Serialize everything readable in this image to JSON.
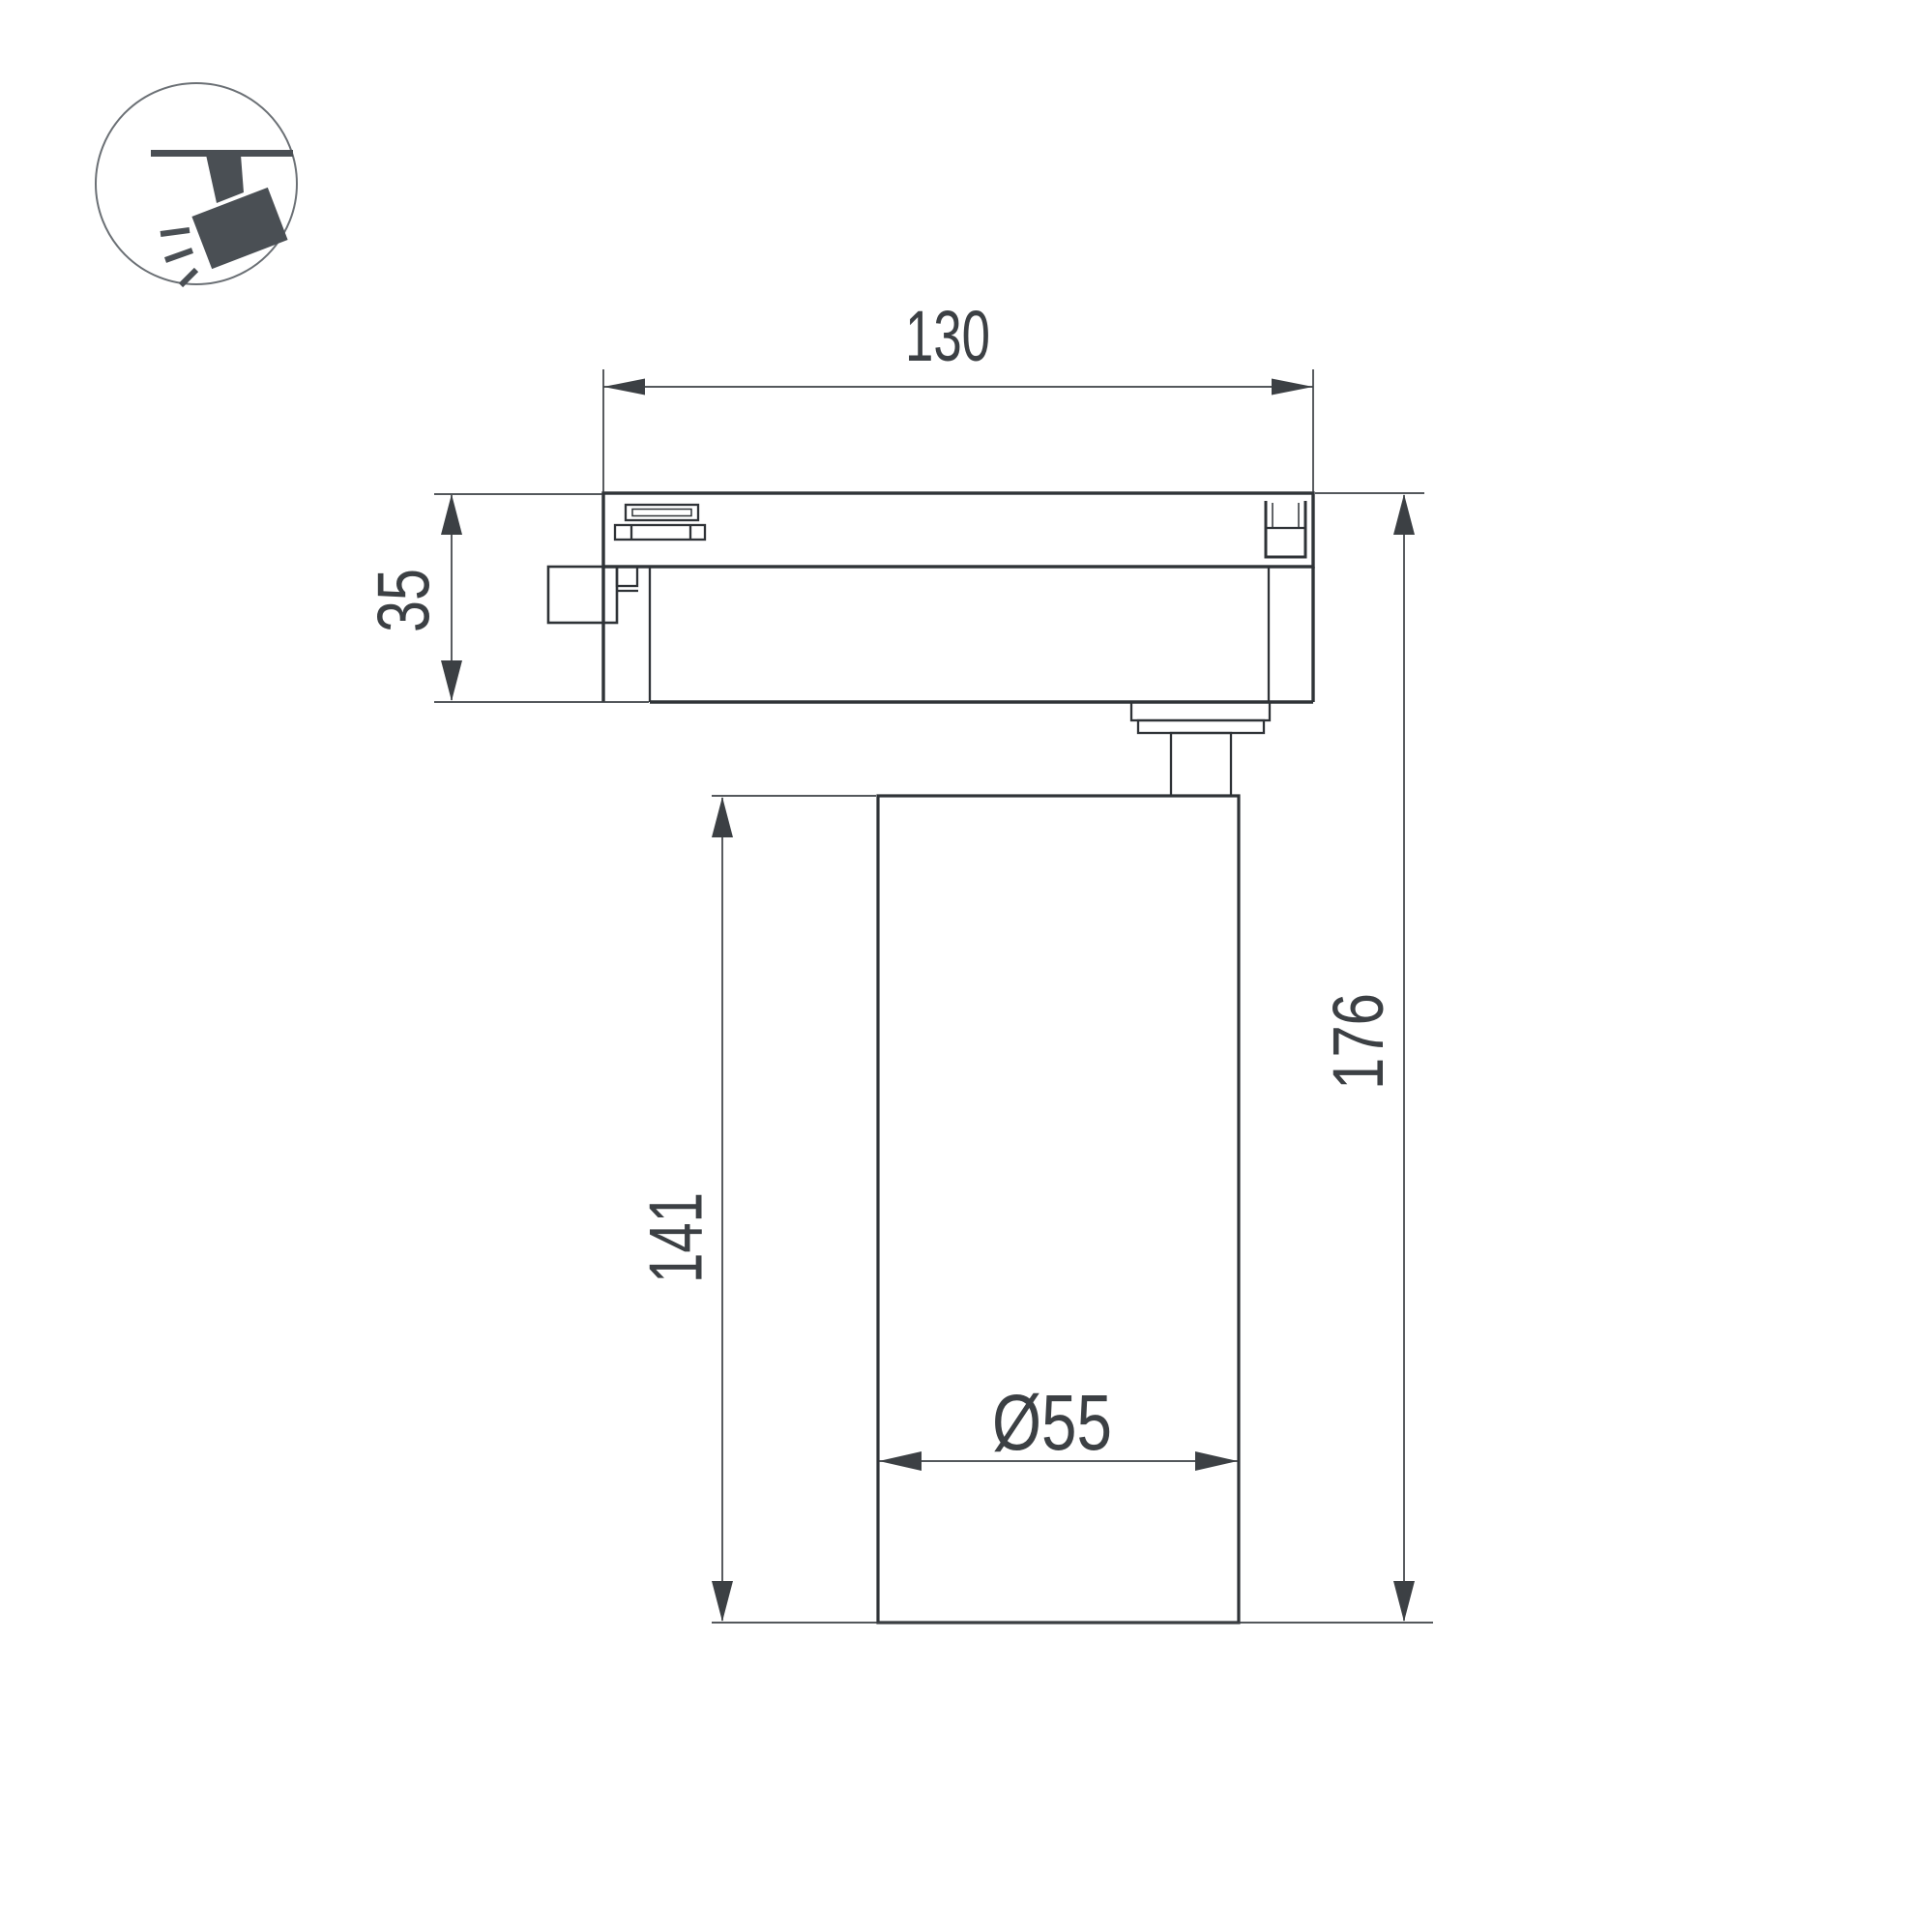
{
  "colors": {
    "background": "#ffffff",
    "part_line": "#2f3337",
    "dimension_line": "#3c4044",
    "icon_fill": "#4a4f54"
  },
  "icon": {
    "name": "track-spotlight-icon"
  },
  "dimensions": {
    "track_width": "130",
    "adapter_height": "35",
    "body_height": "141",
    "total_height": "176",
    "diameter": "Ø55"
  }
}
